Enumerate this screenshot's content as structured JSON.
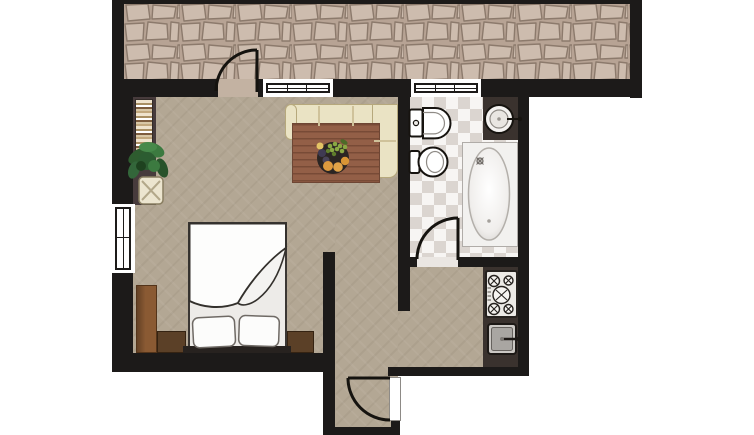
{
  "title": "apartment-floor-plan",
  "colors": {
    "background": "#ffffff",
    "wall": "#1c1a19",
    "carpet": "#b3a794",
    "stone_bg": "#b7a394",
    "stone_fill": "#cdbcae",
    "stone_joint": "#8c7a6c",
    "tile_light": "#f7f5f3",
    "tile_dark": "#dbd5d0",
    "counter": "#3a322e",
    "sofa": "#eae3c4",
    "sofa_outline": "#b6a87c",
    "table_wood": "#935f47",
    "table_wood_dark": "#6e4634",
    "wardrobe_wood": "#8a5a33",
    "nightstand_wood": "#5b4027",
    "bookshelf_back": "#473b3c",
    "fixture_white": "#ffffff",
    "duvet_white": "#fdfdfc",
    "plant_green": "#37703a",
    "metal": "#cbc8c4"
  },
  "rooms": [
    {
      "id": "terrace",
      "floor": "stone-paving"
    },
    {
      "id": "living-bedroom",
      "floor": "carpet"
    },
    {
      "id": "bathroom",
      "floor": "checker-tile"
    },
    {
      "id": "kitchen",
      "floor": "carpet"
    },
    {
      "id": "entry-hall",
      "floor": "carpet"
    }
  ],
  "openings": {
    "doors": [
      {
        "id": "terrace-door",
        "between": [
          "living-bedroom",
          "terrace"
        ],
        "swing": "quarter-arc"
      },
      {
        "id": "bathroom-door",
        "between": [
          "living-bedroom",
          "bathroom"
        ],
        "swing": "quarter-arc"
      },
      {
        "id": "entry-door",
        "between": [
          "outside",
          "entry-hall"
        ],
        "swing": "quarter-arc"
      }
    ],
    "windows": [
      {
        "id": "living-window-top",
        "wall": "top"
      },
      {
        "id": "bathroom-window-top",
        "wall": "top"
      },
      {
        "id": "living-window-left",
        "wall": "left"
      }
    ]
  },
  "furniture": {
    "living_bedroom": [
      "corner-sofa",
      "coffee-table",
      "fruit-bowl",
      "double-bed",
      "pillow-left",
      "pillow-right",
      "duvet",
      "headboard",
      "wardrobe",
      "nightstand-left",
      "nightstand-right",
      "bookshelf",
      "potted-plant"
    ],
    "bathroom": [
      "toilet",
      "bidet",
      "washbasin",
      "basin-counter",
      "bathtub"
    ],
    "kitchen": [
      "cooktop-5-burners",
      "kitchen-sink",
      "kitchen-counter"
    ]
  }
}
